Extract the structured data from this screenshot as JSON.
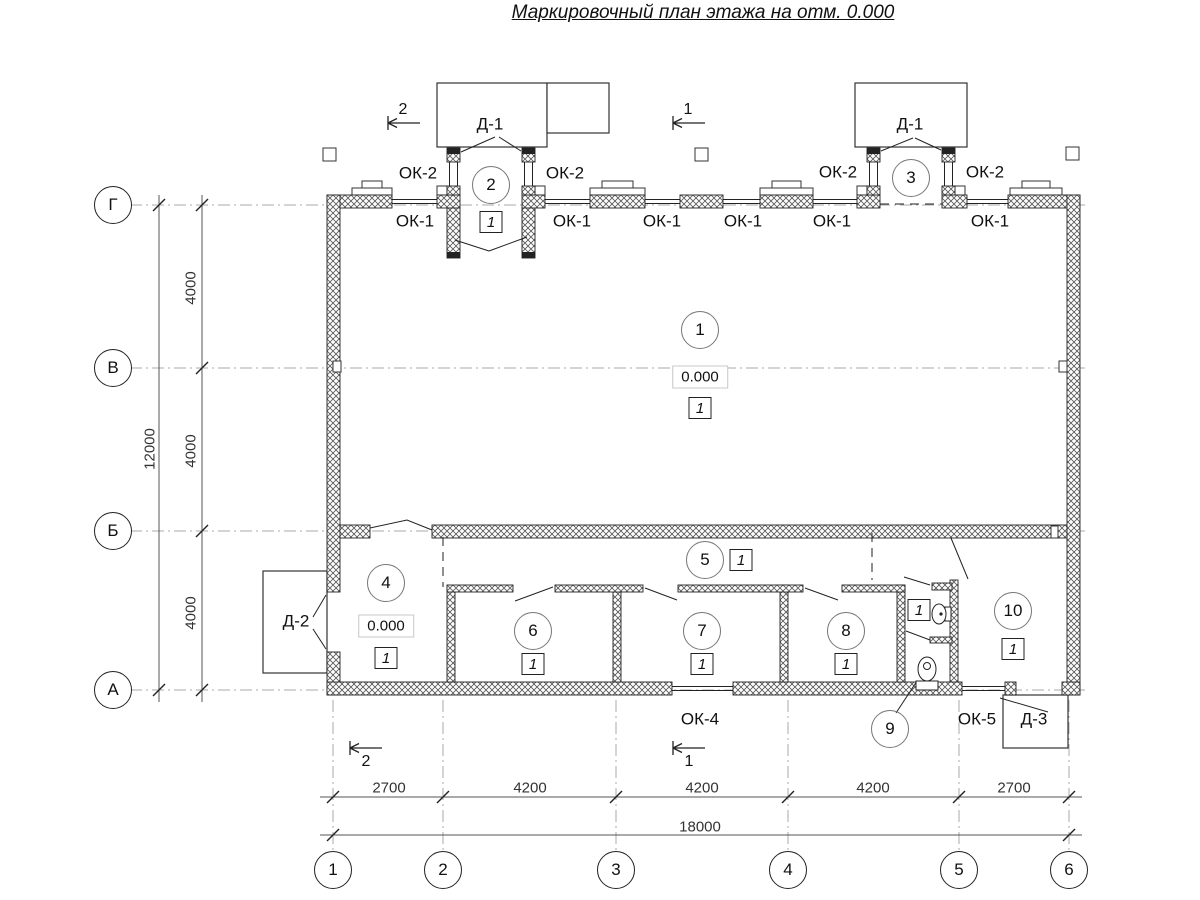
{
  "title": {
    "text": "Маркировочный план этажа на отм. 0.000"
  },
  "colors": {
    "ink": "#1a1a1a",
    "dim_text": "#333333",
    "axis_line": "#a8a8a8",
    "elevation_border": "#c8c8c8"
  },
  "plan_labels": [
    {
      "name": "door-label-d1-left",
      "text": "Д-1",
      "x": 490,
      "y": 124
    },
    {
      "name": "door-label-d1-right",
      "text": "Д-1",
      "x": 910,
      "y": 124
    },
    {
      "name": "door-label-d2",
      "text": "Д-2",
      "x": 296,
      "y": 621
    },
    {
      "name": "door-label-d3",
      "text": "Д-3",
      "x": 1034,
      "y": 719
    },
    {
      "name": "window-label-ok2-1",
      "text": "ОК-2",
      "x": 418,
      "y": 173
    },
    {
      "name": "window-label-ok2-2",
      "text": "ОК-2",
      "x": 565,
      "y": 173
    },
    {
      "name": "window-label-ok2-3",
      "text": "ОК-2",
      "x": 838,
      "y": 172
    },
    {
      "name": "window-label-ok2-4",
      "text": "ОК-2",
      "x": 985,
      "y": 172
    },
    {
      "name": "window-label-ok1-1",
      "text": "ОК-1",
      "x": 415,
      "y": 221
    },
    {
      "name": "window-label-ok1-2",
      "text": "ОК-1",
      "x": 572,
      "y": 221
    },
    {
      "name": "window-label-ok1-3",
      "text": "ОК-1",
      "x": 662,
      "y": 221
    },
    {
      "name": "window-label-ok1-4",
      "text": "ОК-1",
      "x": 743,
      "y": 221
    },
    {
      "name": "window-label-ok1-5",
      "text": "ОК-1",
      "x": 832,
      "y": 221
    },
    {
      "name": "window-label-ok1-6",
      "text": "ОК-1",
      "x": 990,
      "y": 221
    },
    {
      "name": "window-label-ok4",
      "text": "ОК-4",
      "x": 700,
      "y": 719
    },
    {
      "name": "window-label-ok5",
      "text": "ОК-5",
      "x": 977,
      "y": 719
    }
  ],
  "section_marks": [
    {
      "name": "section-mark-2-top",
      "text": "2",
      "x": 403,
      "y": 110
    },
    {
      "name": "section-mark-1-top",
      "text": "1",
      "x": 688,
      "y": 110
    },
    {
      "name": "section-mark-2-bottom",
      "text": "2",
      "x": 366,
      "y": 762
    },
    {
      "name": "section-mark-1-bottom",
      "text": "1",
      "x": 689,
      "y": 762
    }
  ],
  "dimensions": [
    {
      "name": "dim-2700-left",
      "text": "2700",
      "x": 389,
      "y": 788,
      "vertical": false
    },
    {
      "name": "dim-4200-1",
      "text": "4200",
      "x": 530,
      "y": 788,
      "vertical": false
    },
    {
      "name": "dim-4200-2",
      "text": "4200",
      "x": 702,
      "y": 788,
      "vertical": false
    },
    {
      "name": "dim-4200-3",
      "text": "4200",
      "x": 873,
      "y": 788,
      "vertical": false
    },
    {
      "name": "dim-2700-right",
      "text": "2700",
      "x": 1014,
      "y": 788,
      "vertical": false
    },
    {
      "name": "dim-total-18000",
      "text": "18000",
      "x": 700,
      "y": 827,
      "vertical": false
    },
    {
      "name": "dim-4000-top",
      "text": "4000",
      "x": 191,
      "y": 288,
      "vertical": true
    },
    {
      "name": "dim-4000-mid",
      "text": "4000",
      "x": 191,
      "y": 451,
      "vertical": true
    },
    {
      "name": "dim-4000-bottom",
      "text": "4000",
      "x": 191,
      "y": 613,
      "vertical": true
    },
    {
      "name": "dim-total-12000",
      "text": "12000",
      "x": 150,
      "y": 449,
      "vertical": true
    }
  ],
  "rooms": [
    {
      "number": "1",
      "x": 700,
      "y": 330
    },
    {
      "number": "2",
      "x": 491,
      "y": 185
    },
    {
      "number": "3",
      "x": 911,
      "y": 178
    },
    {
      "number": "4",
      "x": 386,
      "y": 583
    },
    {
      "number": "5",
      "x": 705,
      "y": 560
    },
    {
      "number": "6",
      "x": 533,
      "y": 631
    },
    {
      "number": "7",
      "x": 702,
      "y": 631
    },
    {
      "number": "8",
      "x": 846,
      "y": 631
    },
    {
      "number": "9",
      "x": 890,
      "y": 729
    },
    {
      "number": "10",
      "x": 1013,
      "y": 611
    }
  ],
  "floor_markers": [
    {
      "text": "1",
      "x": 700,
      "y": 408
    },
    {
      "text": "1",
      "x": 491,
      "y": 222
    },
    {
      "text": "1",
      "x": 386,
      "y": 658
    },
    {
      "text": "1",
      "x": 741,
      "y": 560
    },
    {
      "text": "1",
      "x": 533,
      "y": 664
    },
    {
      "text": "1",
      "x": 702,
      "y": 664
    },
    {
      "text": "1",
      "x": 846,
      "y": 664
    },
    {
      "text": "1",
      "x": 919,
      "y": 610
    },
    {
      "text": "1",
      "x": 1013,
      "y": 649
    }
  ],
  "elevation_marks": [
    {
      "text": "0.000",
      "x": 700,
      "y": 377
    },
    {
      "text": "0.000",
      "x": 386,
      "y": 626
    }
  ],
  "grid_axes": {
    "bottom_y": 870,
    "bottom": [
      {
        "label": "1",
        "x": 333
      },
      {
        "label": "2",
        "x": 443
      },
      {
        "label": "3",
        "x": 616
      },
      {
        "label": "4",
        "x": 788
      },
      {
        "label": "5",
        "x": 959
      },
      {
        "label": "6",
        "x": 1069
      }
    ],
    "left_x": 113,
    "left": [
      {
        "label": "Г",
        "y": 205
      },
      {
        "label": "В",
        "y": 368
      },
      {
        "label": "Б",
        "y": 531
      },
      {
        "label": "А",
        "y": 690
      }
    ]
  }
}
